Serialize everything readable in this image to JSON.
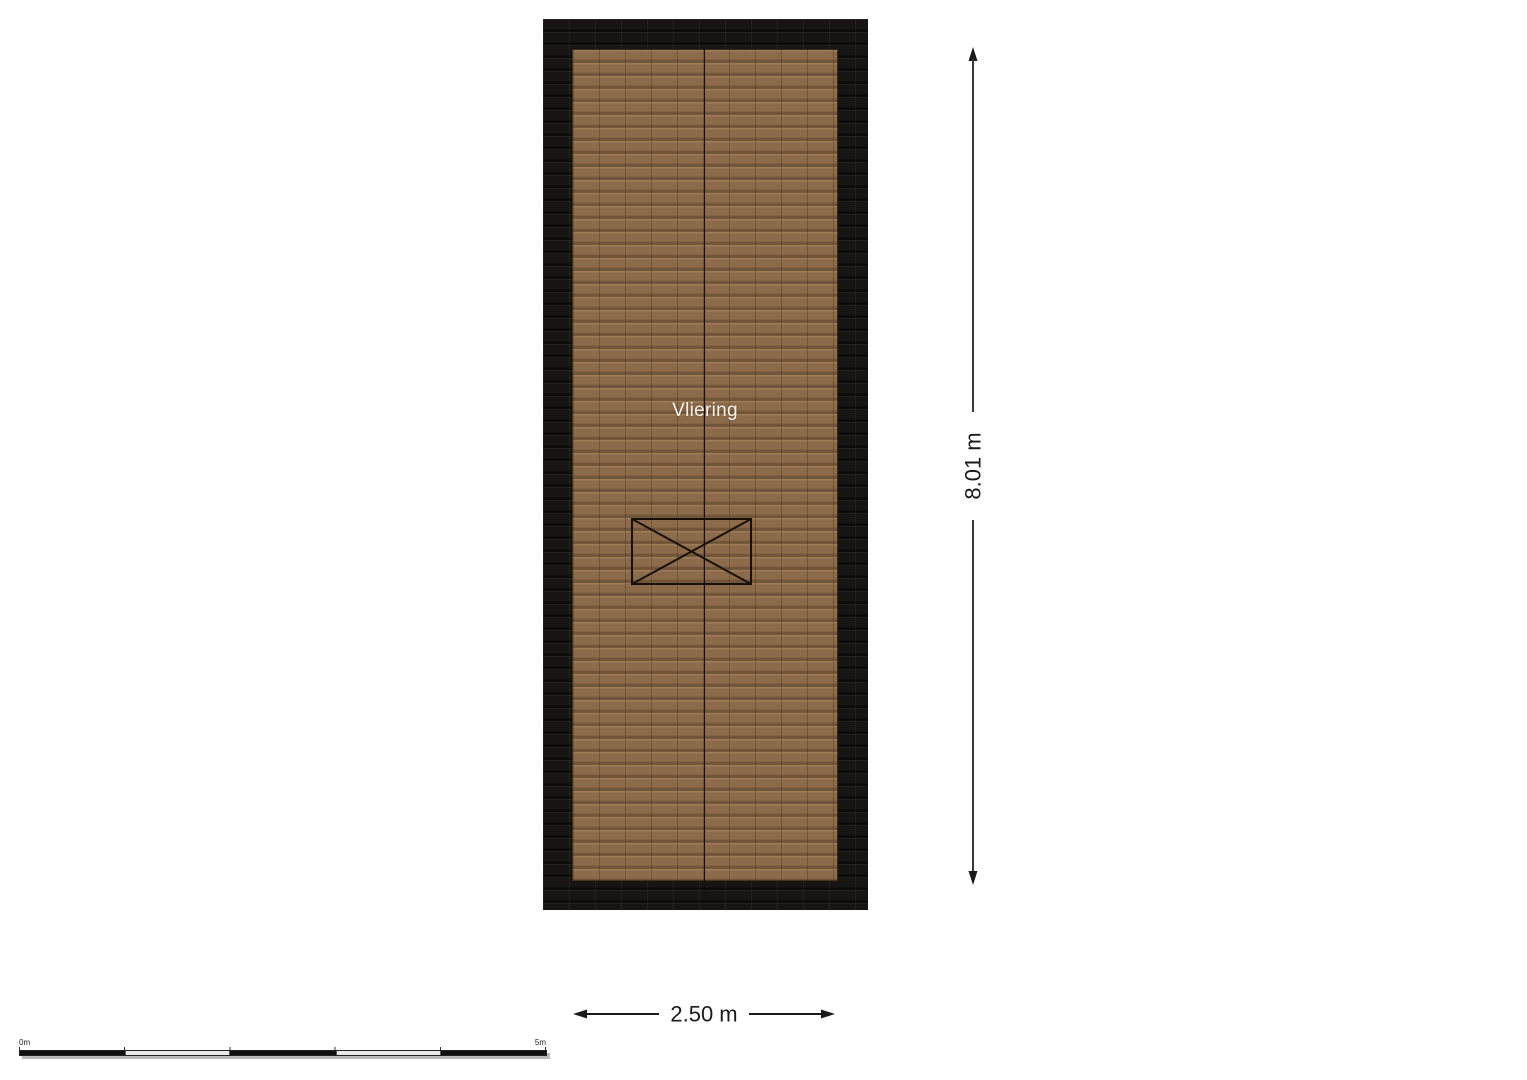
{
  "floorplan": {
    "room_label": "Vliering",
    "features": {
      "roof_hatch": "crossed-rectangle opening",
      "ridge_line": "vertical center ridge"
    }
  },
  "dimensions": {
    "height_label": "8.01 m",
    "width_label": "2.50 m"
  },
  "scale_bar": {
    "start_label": "0m",
    "end_label": "5m",
    "segments": 5
  },
  "colors": {
    "background": "#ffffff",
    "roof_band": "#141311",
    "floor_tiles": "#8c6b4a",
    "room_label_text": "#f7f3ec",
    "dimension_lines": "#1a1a1a"
  }
}
